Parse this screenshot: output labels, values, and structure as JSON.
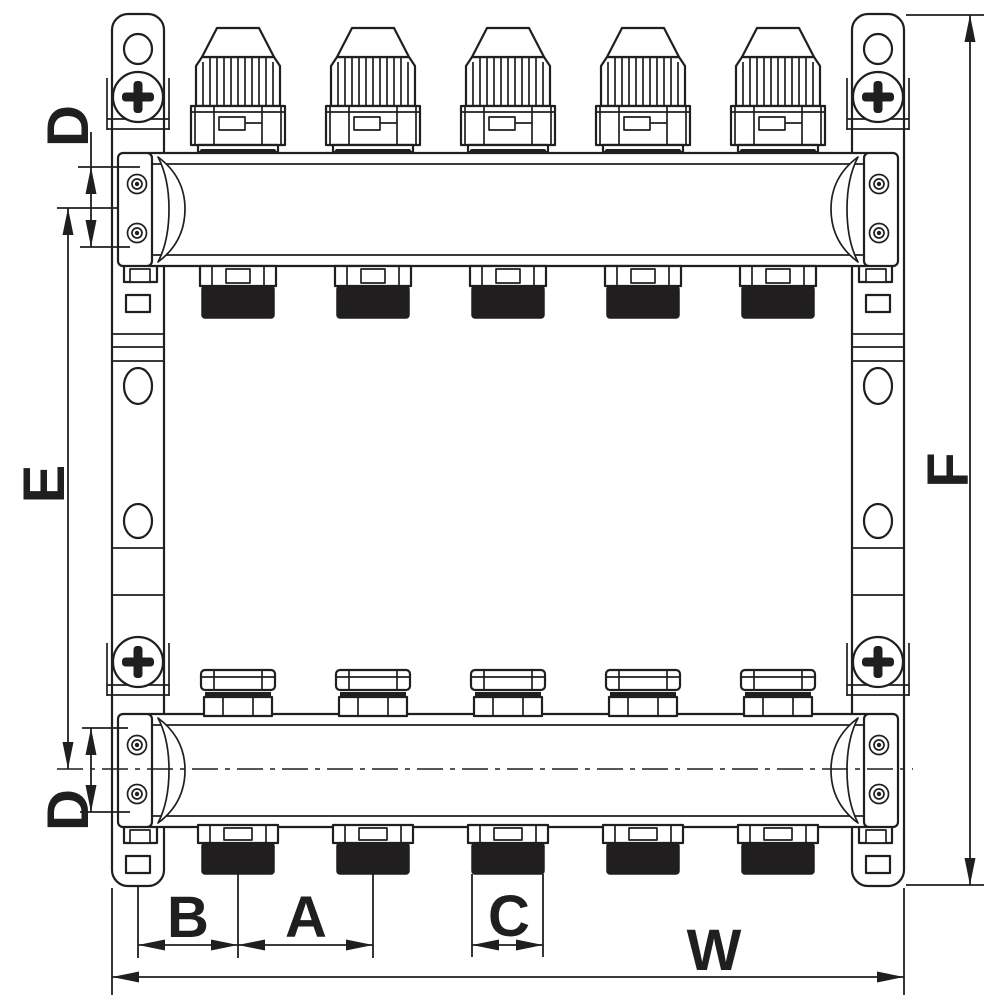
{
  "diagram": {
    "outlet_count": 5,
    "labels": {
      "d_top": "D",
      "e_left": "E",
      "d_bottom": "D",
      "f_right": "F",
      "b": "B",
      "a": "A",
      "c": "C",
      "w": "W"
    }
  },
  "colors": {
    "line": "#1f1f1f",
    "bg": "#ffffff",
    "thread": "#201e1f"
  }
}
